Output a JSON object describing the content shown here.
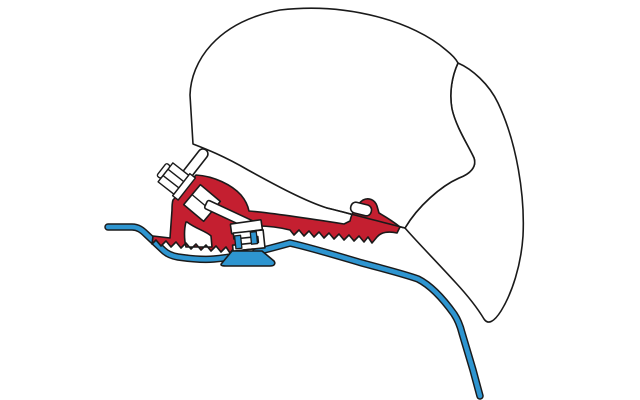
{
  "canvas": {
    "width": 640,
    "height": 400
  },
  "colors": {
    "background": "#ffffff",
    "outline": "#1a1a1a",
    "case_fill": "#ffffff",
    "bracket_red": "#c41f30",
    "rail_blue": "#2e95d0",
    "hardware_white": "#ffffff"
  },
  "parts": {
    "case": "awning-case-profile",
    "flap": "case-side-flap-profile",
    "rail": "vehicle-roof-line",
    "bracket": "adapter-bracket",
    "bolt": "hex-bolt",
    "washer": "washer",
    "nut": "nut-plate",
    "strip": "case-mounting-lip",
    "plate": "adapter-plate",
    "clamp_plate": "clamp-top-plate",
    "clamp": "clamp-body",
    "jaw_left": "rail-flange-left",
    "jaw_right": "rail-flange-right",
    "stem": "clamp-stem",
    "base": "rail-base",
    "hook": "case-lip-hook"
  }
}
